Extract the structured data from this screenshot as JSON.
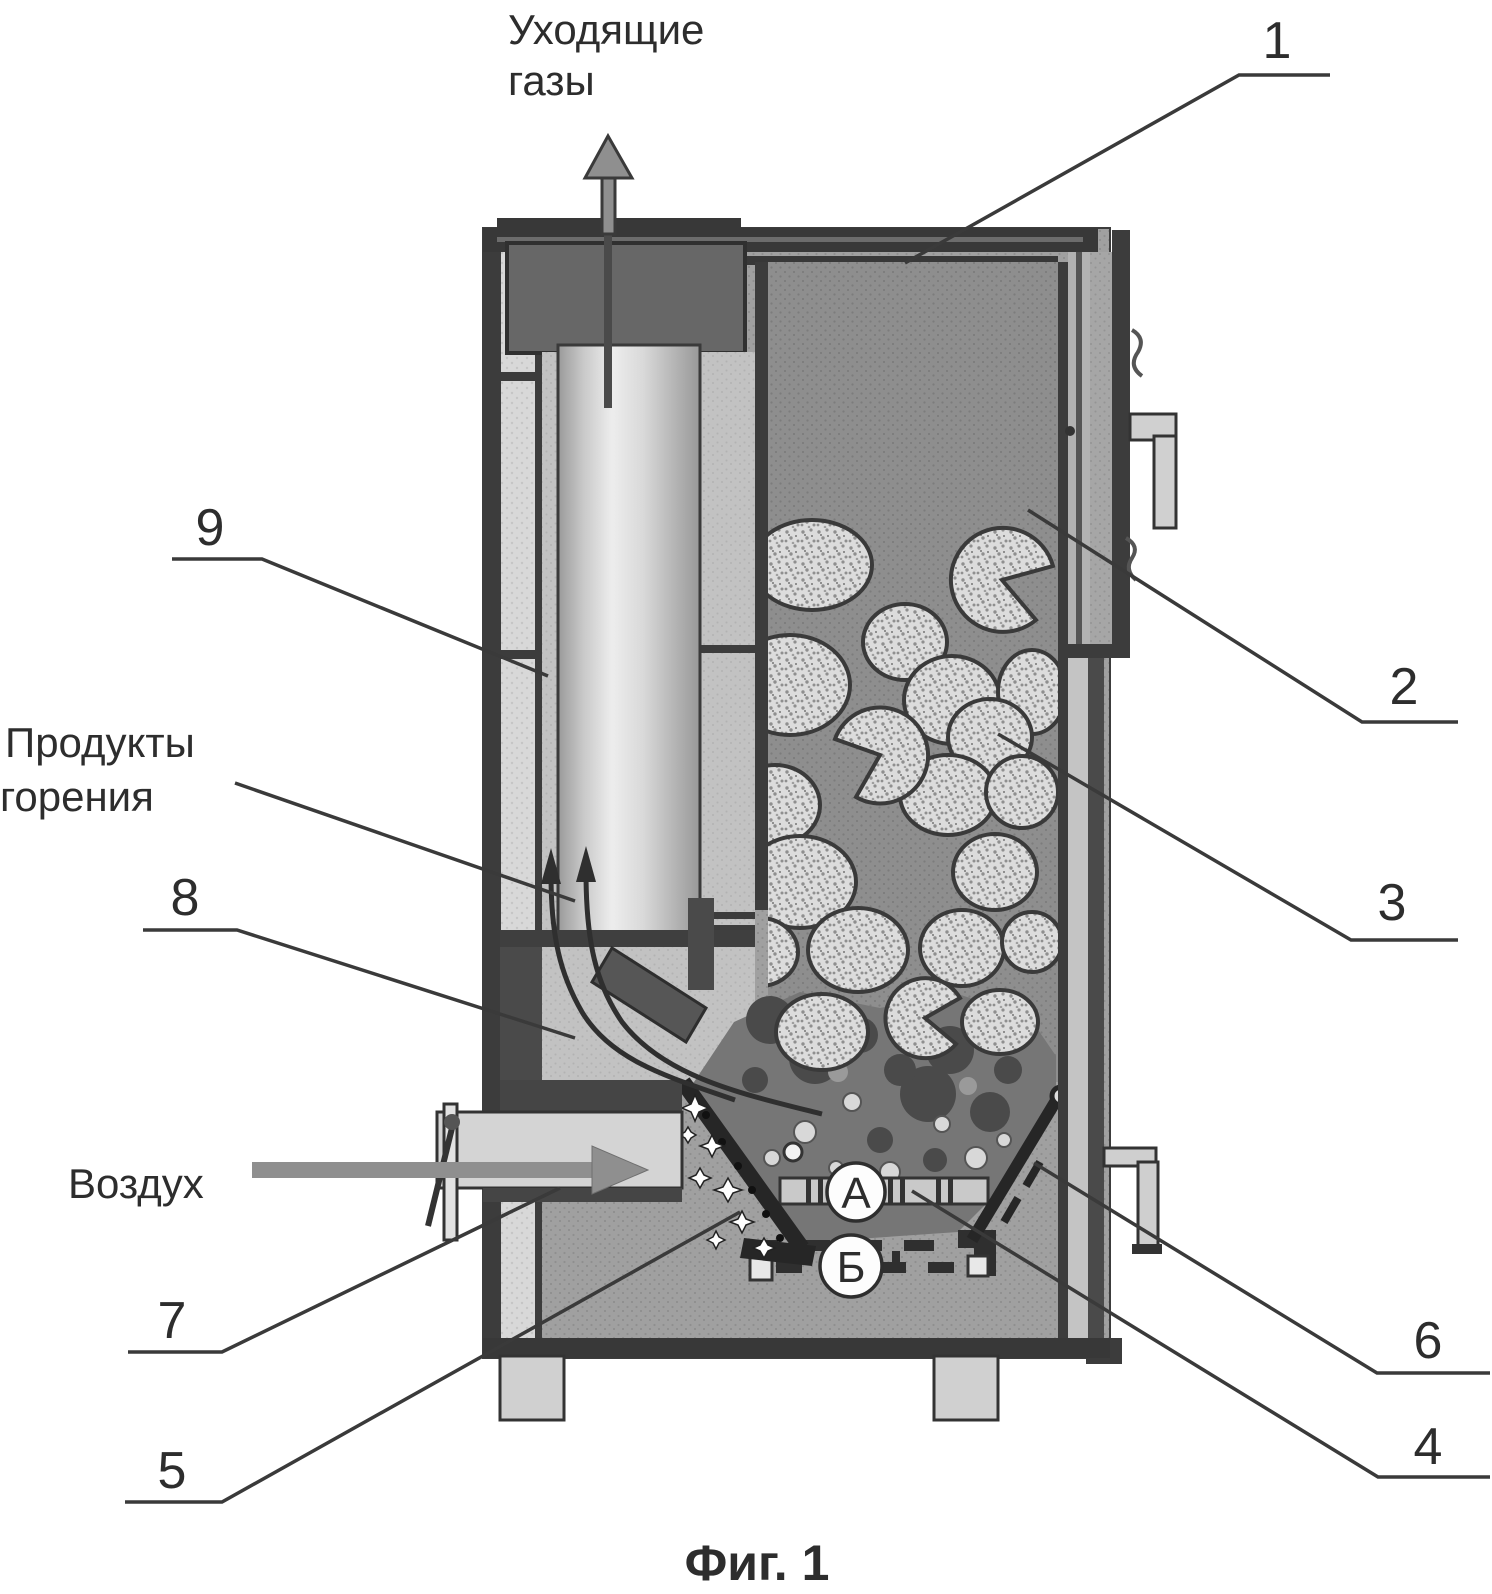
{
  "caption": "Фиг. 1",
  "labels": {
    "exhaust_gases": {
      "line1": "Уходящие",
      "line2": "газы"
    },
    "combustion_products": {
      "line1": "Продукты",
      "line2": "горения"
    },
    "air": "Воздух"
  },
  "callouts": {
    "c1": "1",
    "c2": "2",
    "c3": "3",
    "c4": "4",
    "c5": "5",
    "c6": "6",
    "c7": "7",
    "c8": "8",
    "c9": "9"
  },
  "section_markers": {
    "a": "А",
    "b": "Б"
  },
  "colors": {
    "line": "#3a3a3a",
    "wall_dark": "#3c3c3c",
    "body_gray": "#a0a0a0",
    "hopper_gray": "#8e8e8e",
    "jacket_light": "#d8d8d8",
    "tube_highlight": "#ededed",
    "fuel_light": "#dcdcdc",
    "ember_dark": "#4a4a4a",
    "arrow_gray": "#8f8f8f",
    "background": "#ffffff"
  },
  "icons": {
    "exhaust_arrow": "up-arrow",
    "air_arrow": "right-arrow",
    "flue_gas_arrows": "curved-up-arrows",
    "damper_lever": "lever-with-knob",
    "sparks": "four-point-stars"
  }
}
